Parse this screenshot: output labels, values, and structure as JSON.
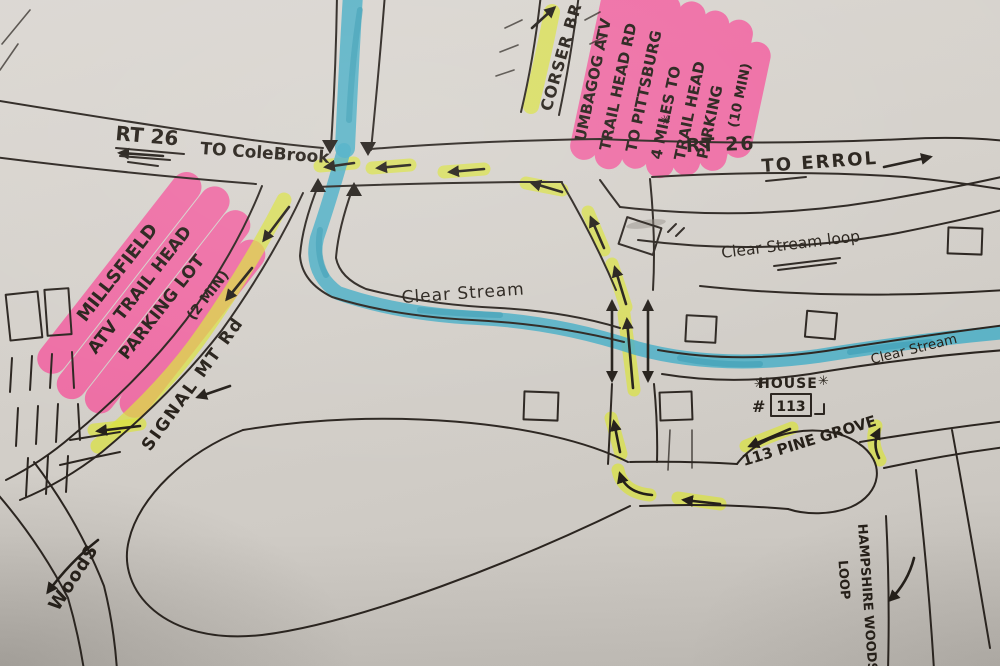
{
  "colors": {
    "paper": "#d3cfc9",
    "ink": "#2b2520",
    "stream_blue": "#49aec6",
    "stream_blue_dark": "#2e95ad",
    "highlighter_yellow": "#d9e23f",
    "highlighter_pink": "#f4559b"
  },
  "glyphs": {
    "star": "✳"
  },
  "labels": {
    "rt26_west": {
      "route": "RT 26",
      "dest": "TO ColeBrook"
    },
    "rt26_east": {
      "route": "RT 26",
      "dest": "TO ERROL"
    },
    "corser_brook": "CORSER BR",
    "clear_stream": "Clear Stream",
    "clear_stream_loop": "Clear Stream loop",
    "clear_stream_right": "Clear Stream",
    "signal_mt_rd": "SIGNAL MT Rd",
    "pine_grove": "113 PINE GROVE",
    "woods": "WoodS",
    "hampshire": {
      "line1": "HAMPSHIRE WOODS",
      "line2": "LOOP"
    }
  },
  "poi": {
    "house": {
      "label": "HOUSE",
      "number_sign": "#",
      "number": "113"
    }
  },
  "notes": {
    "millsfield": {
      "line1": "MILLSFIELD",
      "line2": "ATV TRAIL HEAD",
      "line3": "PARKING LOT",
      "line4": "(2 MIN)"
    },
    "umbagog": {
      "line1": "UMBAGOG ATV",
      "line2": "TRAIL HEAD RD",
      "line3": "TO PITTSBURG",
      "line4": "4 MILES TO",
      "line5": "TRAIL HEAD",
      "line6": "PARKING",
      "line7": "(10 MIN)"
    }
  }
}
